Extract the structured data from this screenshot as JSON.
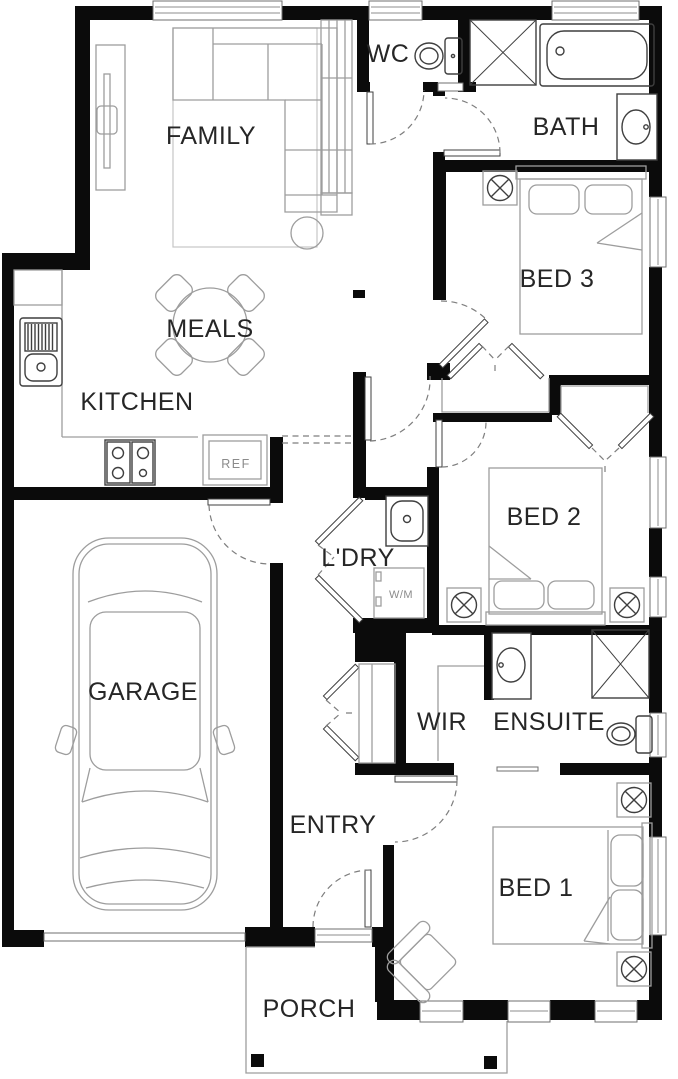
{
  "colors": {
    "wall": "#0b0b0b",
    "fixture_line": "#3f3f3f",
    "furniture_line": "#9d9d9d",
    "dashed_line": "#7e7e7e",
    "label_text": "#262626",
    "background": "#ffffff"
  },
  "rooms": {
    "family": {
      "label": "FAMILY"
    },
    "meals": {
      "label": "MEALS"
    },
    "kitchen": {
      "label": "KITCHEN"
    },
    "wc": {
      "label": "WC"
    },
    "bath": {
      "label": "BATH"
    },
    "bed3": {
      "label": "BED 3"
    },
    "bed2": {
      "label": "BED 2"
    },
    "laundry": {
      "label": "L'DRY"
    },
    "garage": {
      "label": "GARAGE"
    },
    "wir": {
      "label": "WIR"
    },
    "ensuite": {
      "label": "ENSUITE"
    },
    "entry": {
      "label": "ENTRY"
    },
    "bed1": {
      "label": "BED 1"
    },
    "porch": {
      "label": "PORCH"
    }
  },
  "appliances": {
    "fridge": {
      "label": "REF"
    },
    "washing_machine": {
      "label": "W/M"
    }
  }
}
